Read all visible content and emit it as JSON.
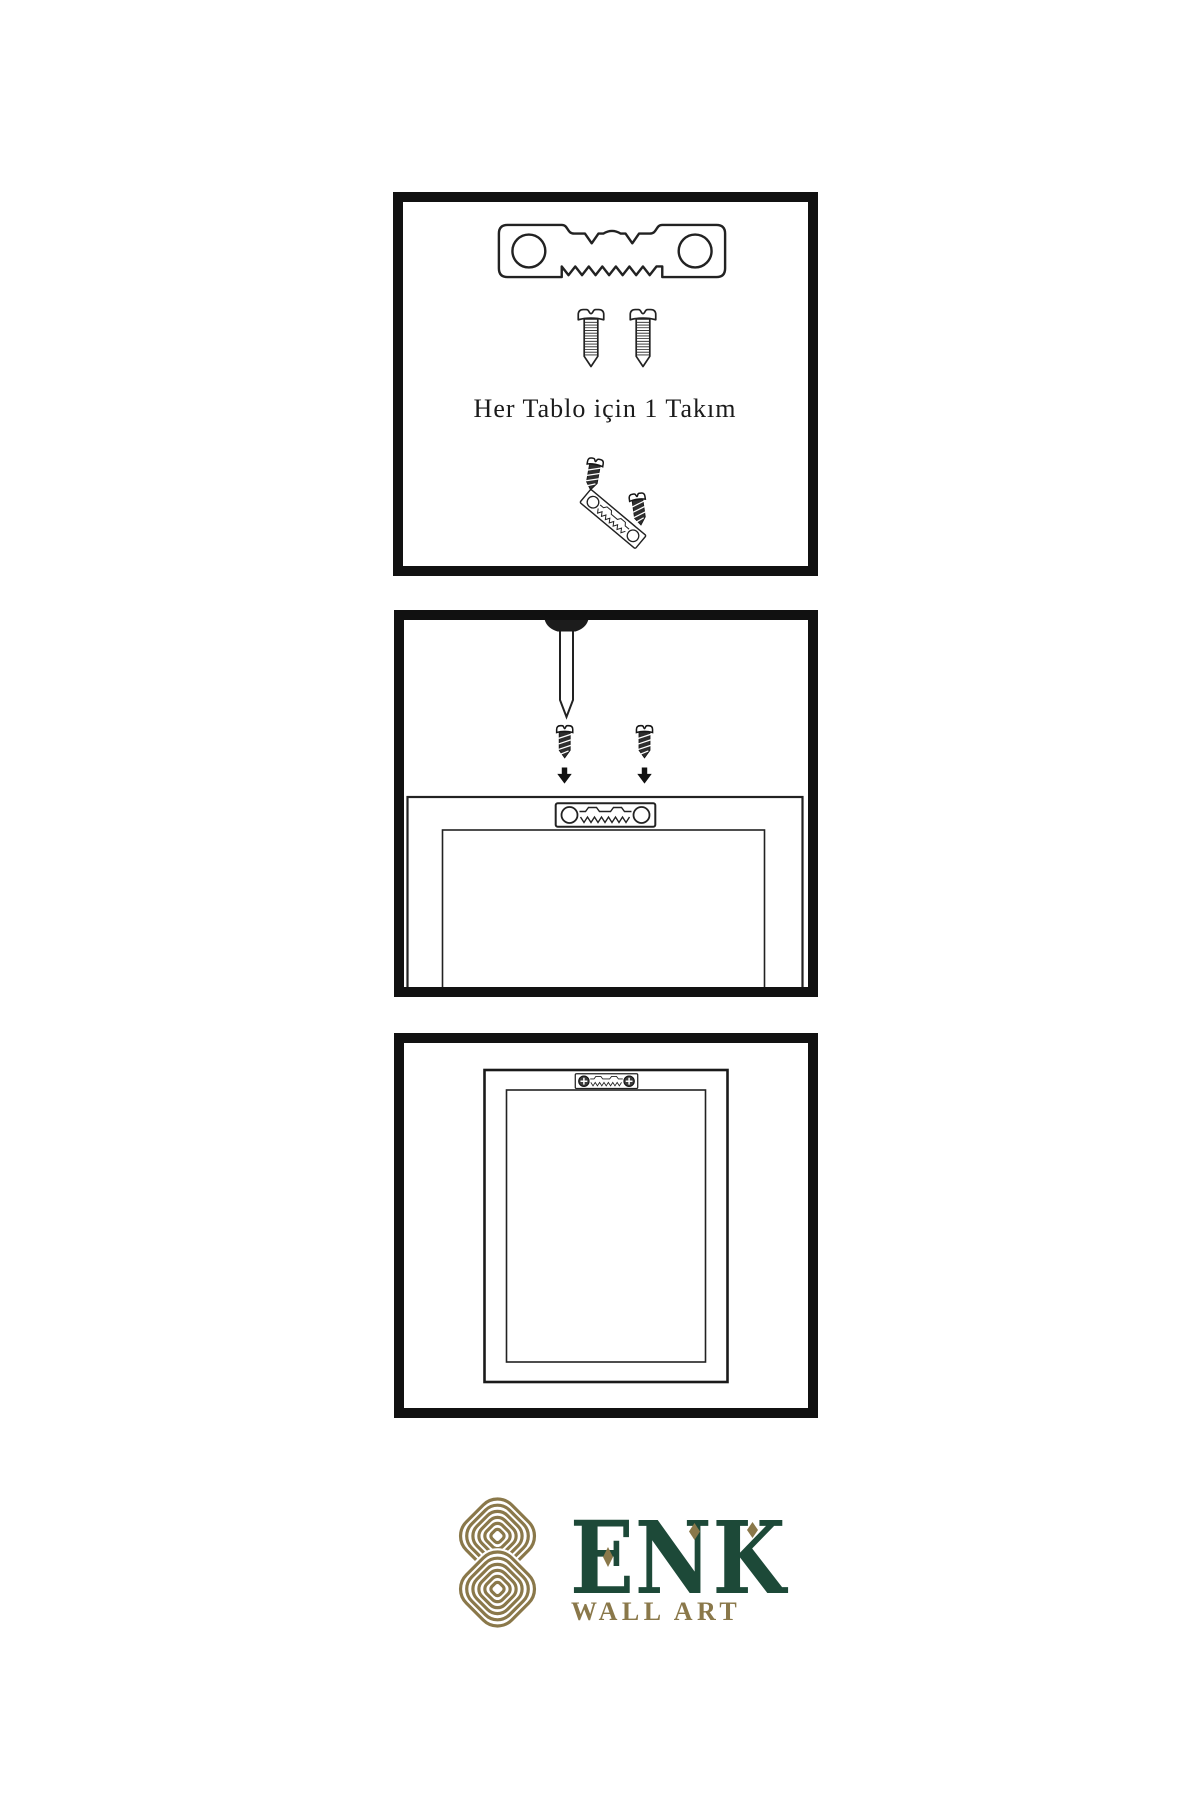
{
  "canvas": {
    "width": 1200,
    "height": 1800,
    "background": "#ffffff",
    "ink_color": "#222222",
    "panel_border_color": "#111111"
  },
  "steps": {
    "step1": {
      "name": "hardware-kit",
      "caption": "Her Tablo için 1 Takım",
      "items": [
        "sawtooth-hanger-icon",
        "mounting-screw-icon",
        "mounting-screw-icon",
        "screw-into-tilted-hanger-icon"
      ]
    },
    "step2": {
      "name": "attach-hanger-to-frame-back",
      "items": [
        "wall-nail-icon",
        "dark-screw-icon",
        "dark-screw-icon",
        "down-arrow-icon",
        "down-arrow-icon",
        "frame-top-rear-view",
        "sawtooth-hanger-icon"
      ]
    },
    "step3": {
      "name": "hanger-mounted-on-frame",
      "items": [
        "frame-rear-view",
        "mounted-sawtooth-hanger-icon",
        "phillips-screw-head-icon",
        "phillips-screw-head-icon"
      ]
    }
  },
  "logo": {
    "wordmark": "ENK",
    "subtitle": "WALL ART",
    "mark": "interlocking-knot",
    "diamond_accents": 3,
    "colors": {
      "green": "#1d4938",
      "gold": "#8a784a"
    }
  }
}
